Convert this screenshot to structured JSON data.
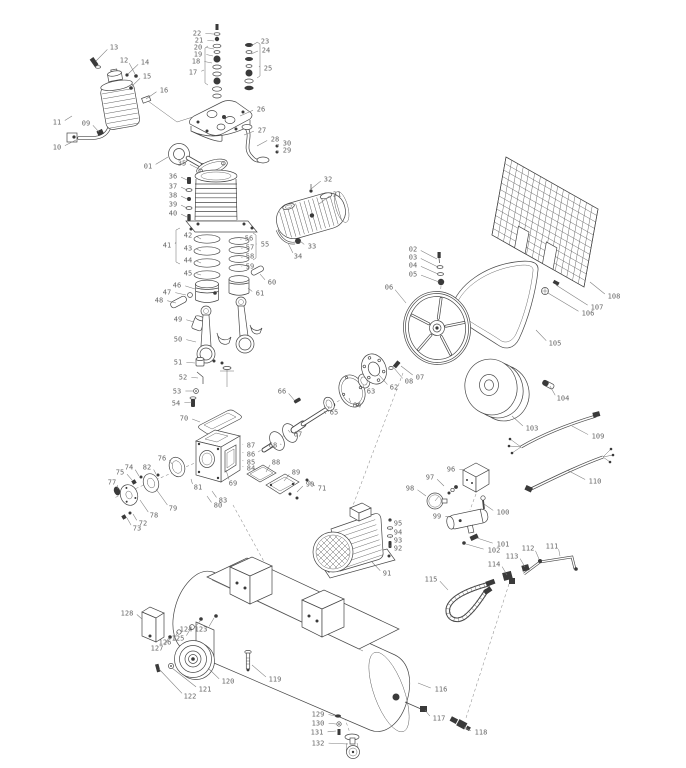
{
  "figure": {
    "type": "exploded-parts-diagram",
    "subject": "belt-driven air compressor pump, flywheel, motor and horizontal tank",
    "background_color": "#ffffff",
    "ink_color": "#474747",
    "label_color": "#666666",
    "part_count": 132
  },
  "diagram": {
    "callout_format": [
      "part_no",
      "text_x",
      "text_y",
      "point_x",
      "point_y"
    ],
    "callouts": [
      [
        "01",
        148,
        166,
        168,
        157
      ],
      [
        "02",
        413,
        249,
        437,
        259
      ],
      [
        "03",
        413,
        257,
        438,
        267
      ],
      [
        "04",
        413,
        265,
        438,
        274
      ],
      [
        "05",
        413,
        274,
        439,
        282
      ],
      [
        "06",
        389,
        287,
        406,
        303
      ],
      [
        "07",
        420,
        377,
        401,
        366
      ],
      [
        "08",
        409,
        381,
        394,
        368
      ],
      [
        "09",
        86,
        123,
        99,
        132
      ],
      [
        "10",
        57,
        147,
        76,
        140
      ],
      [
        "11",
        57,
        122,
        72,
        116
      ],
      [
        "12",
        124,
        60,
        135,
        74
      ],
      [
        "13",
        114,
        47,
        96,
        61
      ],
      [
        "14",
        145,
        62,
        128,
        74
      ],
      [
        "15",
        147,
        76,
        131,
        87
      ],
      [
        "16",
        164,
        90,
        146,
        99
      ],
      [
        "17",
        193,
        72,
        204,
        70
      ],
      [
        "18",
        196,
        61,
        212,
        63
      ],
      [
        "19",
        198,
        54,
        213,
        56
      ],
      [
        "20",
        198,
        47,
        214,
        49
      ],
      [
        "21",
        199,
        40,
        214,
        41
      ],
      [
        "22",
        197,
        33,
        213,
        34
      ],
      [
        "23",
        265,
        41,
        251,
        46
      ],
      [
        "24",
        266,
        50,
        251,
        54
      ],
      [
        "25",
        268,
        68,
        259,
        66
      ],
      [
        "26",
        261,
        109,
        240,
        116
      ],
      [
        "27",
        262,
        130,
        244,
        135
      ],
      [
        "28",
        275,
        139,
        257,
        146
      ],
      [
        "29",
        287,
        150,
        277,
        152
      ],
      [
        "30",
        287,
        143,
        277,
        146
      ],
      [
        "31",
        337,
        194,
        319,
        204
      ],
      [
        "32",
        328,
        179,
        311,
        189
      ],
      [
        "33",
        312,
        246,
        300,
        241
      ],
      [
        "34",
        298,
        256,
        288,
        243
      ],
      [
        "35",
        182,
        163,
        199,
        169
      ],
      [
        "36",
        173,
        176,
        187,
        180
      ],
      [
        "37",
        173,
        186,
        187,
        190
      ],
      [
        "38",
        173,
        195,
        187,
        199
      ],
      [
        "39",
        173,
        204,
        187,
        208
      ],
      [
        "40",
        173,
        213,
        187,
        217
      ],
      [
        "41",
        167,
        245,
        176,
        242
      ],
      [
        "42",
        188,
        235,
        201,
        239
      ],
      [
        "43",
        188,
        248,
        201,
        251
      ],
      [
        "44",
        188,
        260,
        201,
        263
      ],
      [
        "45",
        188,
        273,
        201,
        275
      ],
      [
        "46",
        177,
        285,
        195,
        289
      ],
      [
        "47",
        167,
        292,
        186,
        295
      ],
      [
        "48",
        159,
        300,
        176,
        303
      ],
      [
        "49",
        178,
        319,
        194,
        322
      ],
      [
        "50",
        178,
        339,
        196,
        342
      ],
      [
        "51",
        178,
        362,
        195,
        363
      ],
      [
        "52",
        183,
        377,
        198,
        378
      ],
      [
        "53",
        177,
        391,
        194,
        391
      ],
      [
        "54",
        176,
        403,
        192,
        402
      ],
      [
        "55",
        265,
        244,
        257,
        244
      ],
      [
        "56",
        249,
        238,
        241,
        240
      ],
      [
        "57",
        250,
        247,
        242,
        249
      ],
      [
        "58",
        250,
        256,
        242,
        258
      ],
      [
        "59",
        250,
        266,
        242,
        267
      ],
      [
        "60",
        272,
        282,
        260,
        274
      ],
      [
        "61",
        260,
        293,
        248,
        288
      ],
      [
        "62",
        394,
        387,
        379,
        375
      ],
      [
        "63",
        371,
        391,
        363,
        385
      ],
      [
        "64",
        357,
        405,
        349,
        398
      ],
      [
        "65",
        334,
        412,
        329,
        406
      ],
      [
        "66",
        282,
        391,
        295,
        401
      ],
      [
        "67",
        298,
        434,
        288,
        430
      ],
      [
        "68",
        273,
        445,
        280,
        444
      ],
      [
        "69",
        233,
        483,
        226,
        470
      ],
      [
        "70",
        184,
        418,
        200,
        422
      ],
      [
        "71",
        322,
        488,
        308,
        480
      ],
      [
        "72",
        143,
        523,
        133,
        514
      ],
      [
        "73",
        137,
        528,
        127,
        518
      ],
      [
        "74",
        129,
        467,
        139,
        476
      ],
      [
        "75",
        120,
        472,
        132,
        480
      ],
      [
        "76",
        162,
        458,
        172,
        464
      ],
      [
        "77",
        112,
        482,
        118,
        489
      ],
      [
        "78",
        154,
        515,
        140,
        500
      ],
      [
        "79",
        173,
        508,
        156,
        489
      ],
      [
        "80",
        218,
        505,
        207,
        496
      ],
      [
        "81",
        198,
        487,
        191,
        479
      ],
      [
        "82",
        147,
        467,
        156,
        474
      ],
      [
        "83",
        223,
        500,
        212,
        491
      ],
      [
        "84",
        251,
        468,
        243,
        466
      ],
      [
        "85",
        251,
        462,
        243,
        460
      ],
      [
        "86",
        251,
        454,
        243,
        452
      ],
      [
        "87",
        251,
        445,
        243,
        444
      ],
      [
        "88",
        276,
        462,
        266,
        472
      ],
      [
        "89",
        296,
        472,
        284,
        481
      ],
      [
        "90",
        310,
        484,
        297,
        492
      ],
      [
        "91",
        387,
        573,
        372,
        562
      ],
      [
        "92",
        398,
        548,
        390,
        545
      ],
      [
        "93",
        398,
        540,
        390,
        536
      ],
      [
        "94",
        398,
        532,
        390,
        528
      ],
      [
        "95",
        398,
        523,
        390,
        520
      ],
      [
        "96",
        451,
        469,
        465,
        470
      ],
      [
        "97",
        430,
        477,
        444,
        486
      ],
      [
        "98",
        410,
        488,
        426,
        496
      ],
      [
        "99",
        437,
        516,
        450,
        517
      ],
      [
        "100",
        503,
        512,
        484,
        504
      ],
      [
        "101",
        503,
        544,
        477,
        538
      ],
      [
        "102",
        494,
        550,
        466,
        544
      ],
      [
        "103",
        532,
        428,
        512,
        416
      ],
      [
        "104",
        563,
        398,
        550,
        386
      ],
      [
        "105",
        555,
        343,
        536,
        330
      ],
      [
        "106",
        588,
        313,
        548,
        293
      ],
      [
        "107",
        597,
        307,
        556,
        285
      ],
      [
        "108",
        614,
        296,
        590,
        282
      ],
      [
        "109",
        598,
        436,
        572,
        426
      ],
      [
        "110",
        595,
        481,
        567,
        470
      ],
      [
        "111",
        552,
        546,
        560,
        556
      ],
      [
        "112",
        528,
        548,
        539,
        559
      ],
      [
        "113",
        512,
        556,
        525,
        567
      ],
      [
        "114",
        494,
        564,
        507,
        575
      ],
      [
        "115",
        431,
        579,
        448,
        590
      ],
      [
        "116",
        441,
        689,
        418,
        683
      ],
      [
        "117",
        439,
        718,
        425,
        710
      ],
      [
        "118",
        481,
        732,
        464,
        727
      ],
      [
        "119",
        275,
        679,
        252,
        665
      ],
      [
        "120",
        228,
        681,
        208,
        668
      ],
      [
        "121",
        205,
        689,
        172,
        668
      ],
      [
        "122",
        190,
        696,
        159,
        669
      ],
      [
        "123",
        201,
        629,
        214,
        618
      ],
      [
        "124",
        186,
        629,
        201,
        620
      ],
      [
        "125",
        178,
        638,
        191,
        628
      ],
      [
        "126",
        165,
        642,
        178,
        632
      ],
      [
        "127",
        157,
        648,
        169,
        637
      ],
      [
        "128",
        127,
        613,
        142,
        619
      ],
      [
        "129",
        318,
        714,
        335,
        716
      ],
      [
        "130",
        318,
        723,
        336,
        724
      ],
      [
        "131",
        317,
        732,
        336,
        731
      ],
      [
        "132",
        318,
        743,
        348,
        744
      ]
    ]
  }
}
